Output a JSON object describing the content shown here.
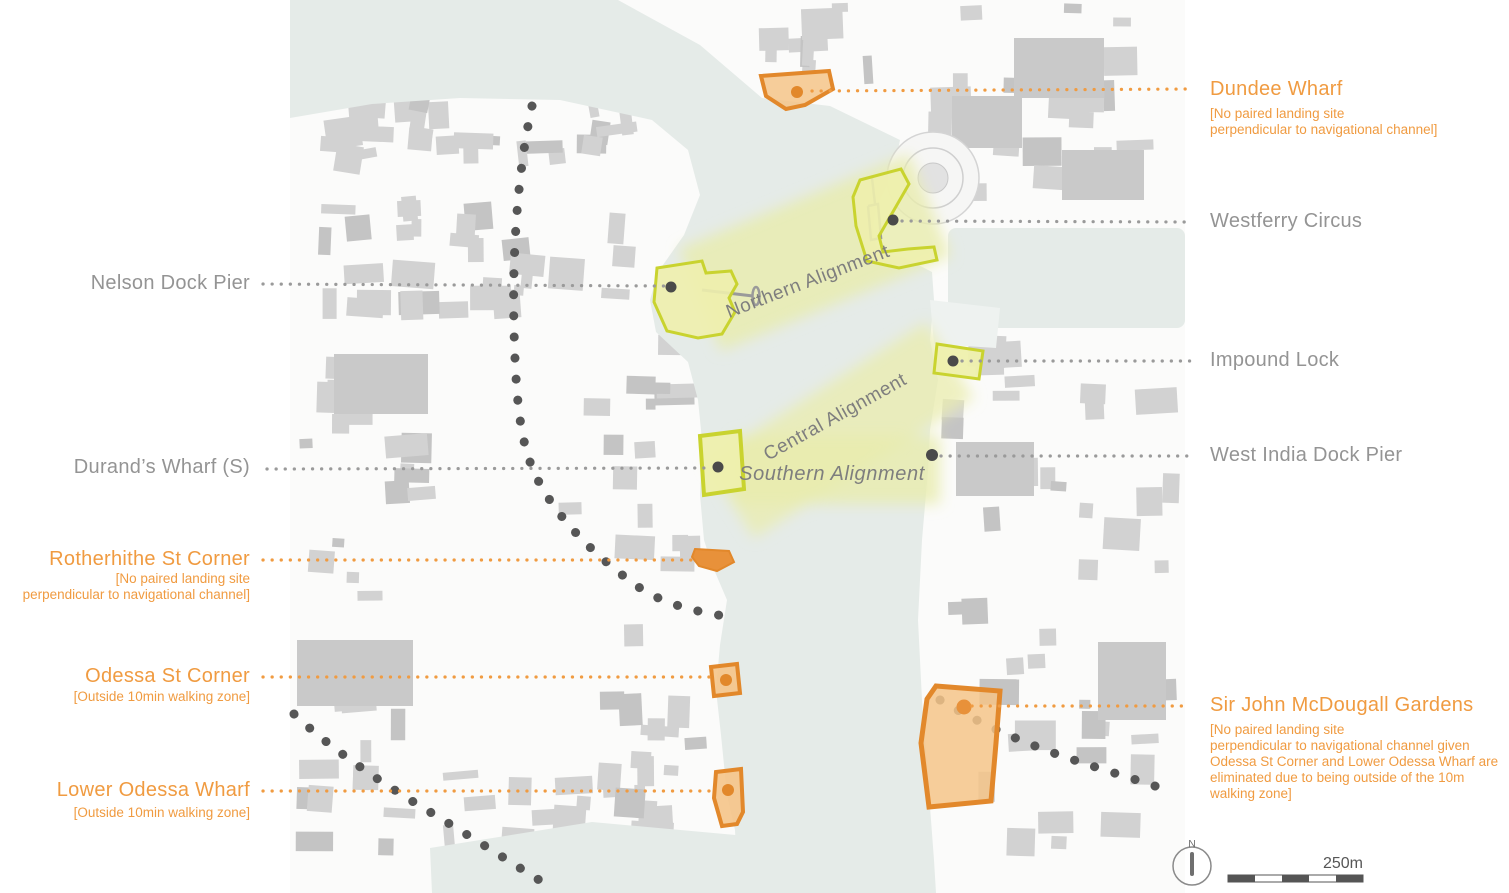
{
  "alignments": [
    {
      "label": "Northern Alignment"
    },
    {
      "label": "Central Alignment"
    },
    {
      "label": "Southern Alignment"
    }
  ],
  "sites_left": [
    {
      "name": "Nelson Dock Pier",
      "status": "neutral",
      "note": ""
    },
    {
      "name": "Durand’s Wharf (S)",
      "status": "neutral",
      "note": ""
    },
    {
      "name": "Rotherhithe St Corner",
      "status": "excluded",
      "note": "[No paired landing site\nperpendicular to navigational channel]"
    },
    {
      "name": "Odessa St Corner",
      "status": "excluded",
      "note": "[Outside 10min walking zone]"
    },
    {
      "name": "Lower Odessa Wharf",
      "status": "excluded",
      "note": "[Outside 10min walking zone]"
    }
  ],
  "sites_right": [
    {
      "name": "Dundee Wharf",
      "status": "excluded",
      "note": "[No paired landing site\nperpendicular to navigational channel]"
    },
    {
      "name": "Westferry Circus",
      "status": "neutral",
      "note": ""
    },
    {
      "name": "Impound Lock",
      "status": "neutral",
      "note": ""
    },
    {
      "name": "West India Dock Pier",
      "status": "neutral",
      "note": ""
    },
    {
      "name": "Sir John McDougall Gardens",
      "status": "excluded",
      "note": "[No paired landing site\nperpendicular to navigational channel given\nOdessa St Corner and Lower Odessa Wharf are\neliminated due to being outside of the 10m\nwalking zone]"
    }
  ],
  "legend": {
    "scale_label": "250m",
    "north_label": "N"
  },
  "colors": {
    "water": "#e5ebe8",
    "land": "#fbfbfa",
    "building": "#d2d2d2",
    "corridor": "#e9ecad",
    "yellow_stroke": "#c9d32f",
    "yellow_fill": "#eef0ad",
    "orange_stroke": "#e2882b",
    "orange_fill": "#f5c488",
    "label_orange": "#f09b41",
    "label_gray": "#949494",
    "route_dot": "#565656"
  }
}
